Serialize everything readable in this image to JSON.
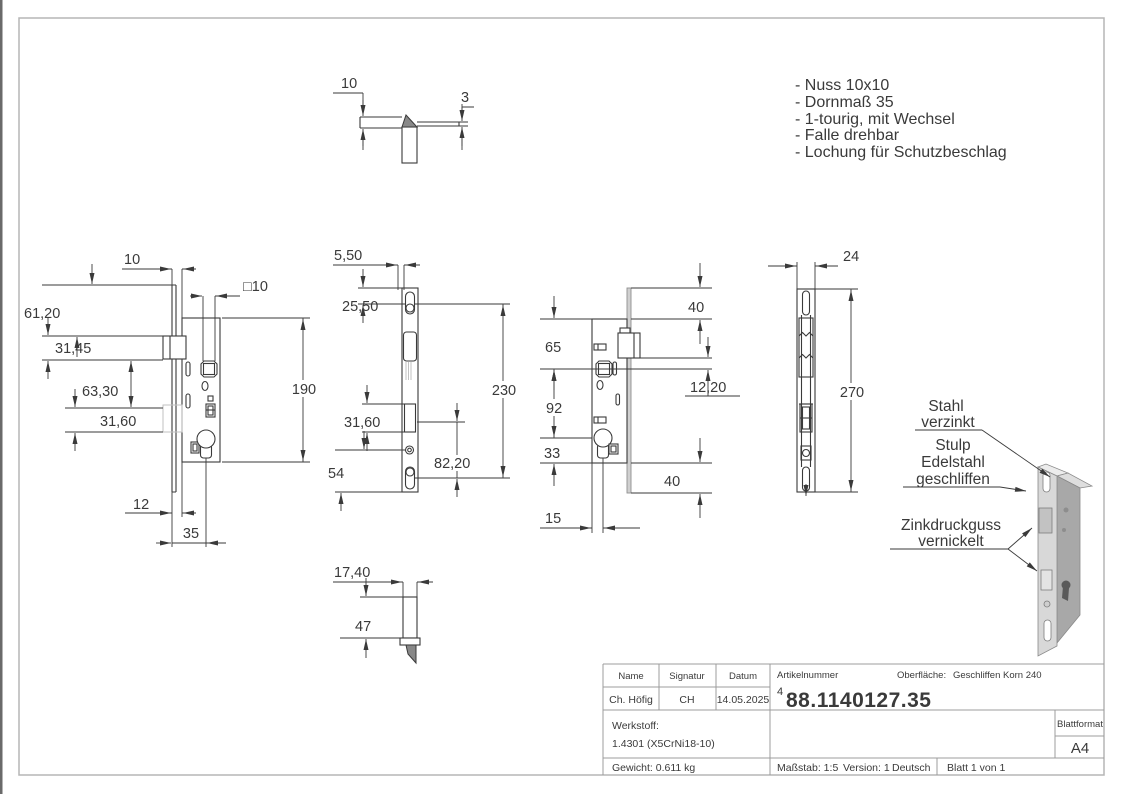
{
  "annotations": {
    "items": [
      "- Nuss 10x10",
      "- Dornmaß 35",
      "- 1-tourig, mit Wechsel",
      "- Falle drehbar",
      "- Lochung für Schutzbeschlag"
    ]
  },
  "material_labels": {
    "stahl": [
      "Stahl",
      "verzinkt"
    ],
    "stulp": [
      "Stulp",
      "Edelstahl",
      "geschliffen"
    ],
    "zink": [
      "Zinkdruckguss",
      "vernickelt"
    ]
  },
  "dimensions": {
    "top_detail": [
      "10",
      "3"
    ],
    "side_left": [
      "10",
      "□10",
      "61,20",
      "31,45",
      "63,30",
      "31,60",
      "190",
      "12",
      "35"
    ],
    "stulp_front": [
      "5,50",
      "25,50",
      "31,60",
      "54",
      "230",
      "82,20"
    ],
    "side_right": [
      "40",
      "65",
      "12,20",
      "92",
      "33",
      "40",
      "15"
    ],
    "front": [
      "24",
      "270"
    ],
    "bottom_detail": [
      "17,40",
      "47"
    ]
  },
  "title_block": {
    "name_label": "Name",
    "signatur_label": "Signatur",
    "datum_label": "Datum",
    "name": "Ch. Höfig",
    "signatur": "CH",
    "datum": "14.05.2025",
    "artikelnummer_label": "Artikelnummer",
    "artikelnummer_prefix": "4",
    "artikelnummer": "88.1140127.35",
    "oberflaeche_label": "Oberfläche:",
    "oberflaeche": "Geschliffen Korn 240",
    "werkstoff_label": "Werkstoff:",
    "werkstoff": "1.4301 (X5CrNi18-10)",
    "gewicht": "Gewicht: 0.611 kg",
    "massstab": "Maßstab: 1:5",
    "version": "Version: 1",
    "sprache": "Deutsch",
    "blatt": "Blatt 1 von 1",
    "blattformat_label": "Blattformat",
    "blattformat": "A4"
  },
  "colors": {
    "line": "#3a3a3a",
    "frame": "#b5b5b5",
    "hidden": "#c2c2c2",
    "iso_front": "#d8d8d8",
    "iso_side": "#a8a8a8"
  }
}
